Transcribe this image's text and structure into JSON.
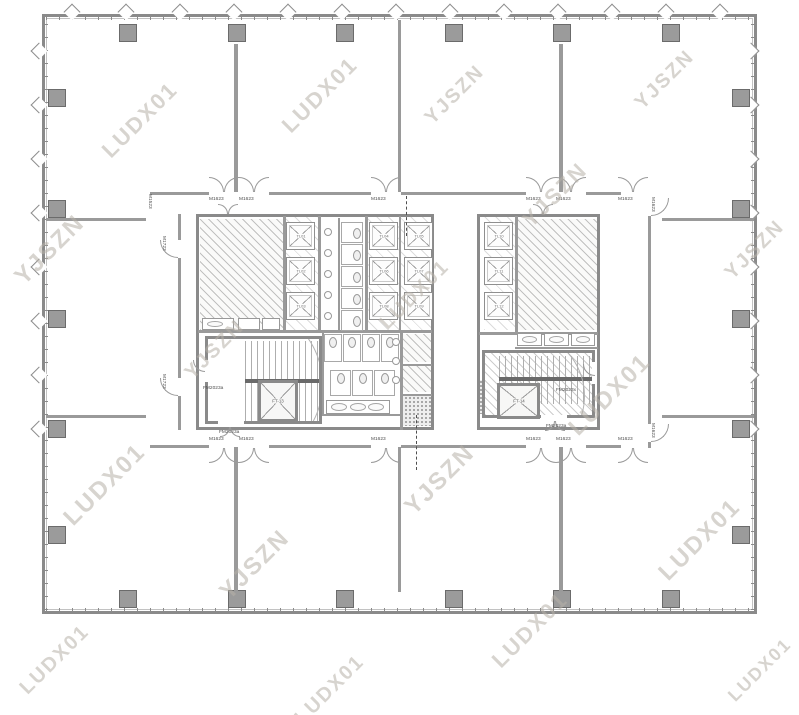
{
  "colors": {
    "wall": "#8a8a8a",
    "line": "#9a9a9a",
    "column": "#9b9b9b",
    "column_border": "#6b6b6b",
    "watermark": "#b7b1a8",
    "dash": "#4f4f4f",
    "label_text": "#4d4d4d"
  },
  "watermark": {
    "texts": [
      "LUDX01",
      "YJSZN"
    ],
    "items": [
      [
        50,
        250,
        "YJSZN",
        24
      ],
      [
        140,
        120,
        "LUDX01",
        22
      ],
      [
        105,
        485,
        "LUDX01",
        24
      ],
      [
        55,
        660,
        "LUDX01",
        20
      ],
      [
        215,
        350,
        "YJSZN",
        20
      ],
      [
        255,
        565,
        "YJSZN",
        24
      ],
      [
        320,
        95,
        "LUDX01",
        22
      ],
      [
        330,
        690,
        "LUDX01",
        20
      ],
      [
        415,
        295,
        "LUDX01",
        20
      ],
      [
        440,
        480,
        "YJSZN",
        24
      ],
      [
        455,
        95,
        "YJSZN",
        20
      ],
      [
        530,
        630,
        "LUDX01",
        22
      ],
      [
        555,
        195,
        "YJSZN",
        22
      ],
      [
        610,
        395,
        "LUDX01",
        24
      ],
      [
        665,
        80,
        "YJSZN",
        20
      ],
      [
        700,
        540,
        "LUDX01",
        24
      ],
      [
        755,
        250,
        "YJSZN",
        20
      ],
      [
        760,
        670,
        "LUDX01",
        18
      ]
    ]
  },
  "shell": {
    "x": 42,
    "y": 14,
    "w": 715,
    "h": 600
  },
  "columns": [
    [
      119,
      24
    ],
    [
      228,
      24
    ],
    [
      336,
      24
    ],
    [
      445,
      24
    ],
    [
      553,
      24
    ],
    [
      662,
      24
    ],
    [
      119,
      590
    ],
    [
      228,
      590
    ],
    [
      336,
      590
    ],
    [
      445,
      590
    ],
    [
      553,
      590
    ],
    [
      662,
      590
    ],
    [
      48,
      89
    ],
    [
      48,
      200
    ],
    [
      48,
      310
    ],
    [
      48,
      420
    ],
    [
      48,
      526
    ],
    [
      732,
      89
    ],
    [
      732,
      200
    ],
    [
      732,
      310
    ],
    [
      732,
      420
    ],
    [
      732,
      526
    ]
  ],
  "windows": {
    "top": [
      72,
      126,
      180,
      234,
      288,
      342,
      396,
      450,
      504,
      558,
      612,
      666,
      720
    ],
    "left": [
      51,
      105,
      159,
      213,
      267,
      321,
      375,
      429
    ],
    "right": [
      51,
      105,
      159,
      213,
      267,
      321,
      375,
      429
    ]
  },
  "walls": [
    [
      234,
      44,
      4,
      148
    ],
    [
      398,
      20,
      3,
      172
    ],
    [
      559,
      44,
      4,
      148
    ],
    [
      234,
      447,
      4,
      145
    ],
    [
      398,
      447,
      3,
      145
    ],
    [
      559,
      447,
      4,
      145
    ],
    [
      46,
      218,
      100,
      3
    ],
    [
      46,
      415,
      100,
      3
    ],
    [
      662,
      218,
      92,
      3
    ],
    [
      662,
      415,
      92,
      3
    ],
    [
      150,
      192,
      59,
      3
    ],
    [
      269,
      192,
      102,
      3
    ],
    [
      401,
      192,
      125,
      3
    ],
    [
      586,
      192,
      35,
      3
    ],
    [
      150,
      445,
      59,
      3
    ],
    [
      269,
      445,
      102,
      3
    ],
    [
      401,
      445,
      125,
      3
    ],
    [
      586,
      445,
      35,
      3
    ],
    [
      178,
      214,
      3,
      26
    ],
    [
      178,
      258,
      3,
      120
    ],
    [
      178,
      396,
      3,
      34
    ],
    [
      648,
      216,
      3,
      208
    ],
    [
      648,
      442,
      3,
      6
    ],
    [
      283,
      216,
      3,
      116
    ],
    [
      318,
      216,
      3,
      116
    ],
    [
      365,
      216,
      3,
      116
    ],
    [
      399,
      216,
      2,
      114
    ],
    [
      198,
      330,
      234,
      3
    ],
    [
      322,
      332,
      2,
      84
    ],
    [
      322,
      414,
      78,
      2
    ],
    [
      400,
      332,
      3,
      98
    ],
    [
      400,
      364,
      32,
      2
    ],
    [
      400,
      394,
      32,
      2
    ],
    [
      338,
      218,
      2,
      112
    ],
    [
      515,
      216,
      3,
      116
    ],
    [
      479,
      332,
      119,
      3
    ],
    [
      515,
      347,
      83,
      2
    ]
  ],
  "cores": [
    [
      196,
      214,
      238,
      216
    ],
    [
      477,
      214,
      123,
      216
    ]
  ],
  "rooms": [
    {
      "x": 200,
      "y": 219,
      "w": 83,
      "h": 111,
      "t": "hatch"
    },
    {
      "x": 283,
      "y": 216,
      "w": 35,
      "h": 114,
      "t": "hlight"
    },
    {
      "x": 365,
      "y": 216,
      "w": 69,
      "h": 114,
      "t": "hlight"
    },
    {
      "x": 484,
      "y": 216,
      "w": 31,
      "h": 114,
      "t": "hlight"
    },
    {
      "x": 517,
      "y": 219,
      "w": 80,
      "h": 111,
      "t": "hatch"
    },
    {
      "x": 400,
      "y": 334,
      "w": 32,
      "h": 28,
      "t": "hatch"
    },
    {
      "x": 400,
      "y": 366,
      "w": 32,
      "h": 26,
      "t": "hatch"
    },
    {
      "x": 400,
      "y": 396,
      "w": 32,
      "h": 30,
      "t": "speckle"
    },
    {
      "x": 479,
      "y": 380,
      "w": 15,
      "h": 34,
      "t": "speckle"
    }
  ],
  "stairs": [
    {
      "x": 205,
      "y": 336,
      "w": 117,
      "h": 88,
      "hatched": false,
      "treads": [
        37,
        2,
        78,
        84
      ],
      "landing": [
        37,
        40,
        78,
        4
      ],
      "arc": [
        -45,
        -35,
        160
      ]
    },
    {
      "x": 482,
      "y": 350,
      "w": 113,
      "h": 68,
      "hatched": true,
      "treads": [
        14,
        3,
        94,
        48
      ],
      "landing": [
        14,
        24,
        94,
        4
      ],
      "arc": [
        -30,
        -22,
        130
      ]
    }
  ],
  "elevators": {
    "car_w": 29,
    "car_h": 28,
    "cars": [
      {
        "x": 286,
        "y": 222,
        "label": "TL01"
      },
      {
        "x": 286,
        "y": 257,
        "label": "TL02"
      },
      {
        "x": 286,
        "y": 292,
        "label": "TL03"
      },
      {
        "x": 369,
        "y": 222,
        "label": "TL04"
      },
      {
        "x": 404,
        "y": 222,
        "label": "TL05"
      },
      {
        "x": 369,
        "y": 257,
        "label": "TL06"
      },
      {
        "x": 404,
        "y": 257,
        "label": "TL07"
      },
      {
        "x": 369,
        "y": 292,
        "label": "TL08"
      },
      {
        "x": 404,
        "y": 292,
        "label": "TL09"
      },
      {
        "x": 484,
        "y": 222,
        "label": "TL10"
      },
      {
        "x": 484,
        "y": 257,
        "label": "TL11"
      },
      {
        "x": 484,
        "y": 292,
        "label": "TL12"
      }
    ],
    "service_lifts": [
      {
        "x": 258,
        "y": 380,
        "w": 40,
        "h": 42,
        "label": "FT-13"
      },
      {
        "x": 497,
        "y": 383,
        "w": 43,
        "h": 36,
        "label": "FT-14"
      }
    ]
  },
  "fixtures": {
    "urinals": [
      [
        324,
        228
      ],
      [
        324,
        249
      ],
      [
        324,
        270
      ],
      [
        324,
        291
      ],
      [
        324,
        312
      ],
      [
        392,
        338
      ],
      [
        392,
        357
      ],
      [
        392,
        376
      ]
    ],
    "stall_groups": [
      {
        "w": 22,
        "h": 21,
        "wc": "r",
        "list": [
          [
            341,
            222
          ],
          [
            341,
            244
          ],
          [
            341,
            266
          ],
          [
            341,
            288
          ],
          [
            341,
            310
          ]
        ]
      },
      {
        "w": 18,
        "h": 28,
        "wc": "t",
        "list": [
          [
            324,
            334
          ],
          [
            343,
            334
          ],
          [
            362,
            334
          ],
          [
            381,
            334
          ]
        ]
      },
      {
        "w": 21,
        "h": 26,
        "wc": "t",
        "list": [
          [
            330,
            370
          ],
          [
            352,
            370
          ],
          [
            374,
            370
          ]
        ]
      }
    ],
    "counters": [
      {
        "x": 326,
        "y": 400,
        "w": 64,
        "h": 14,
        "basins": 3
      },
      {
        "x": 517,
        "y": 333,
        "w": 25,
        "h": 13,
        "basins": 1
      },
      {
        "x": 544,
        "y": 333,
        "w": 25,
        "h": 13,
        "basins": 1
      },
      {
        "x": 571,
        "y": 333,
        "w": 24,
        "h": 13,
        "basins": 1
      },
      {
        "x": 202,
        "y": 318,
        "w": 32,
        "h": 12,
        "basins": 1
      },
      {
        "x": 238,
        "y": 318,
        "w": 22,
        "h": 12,
        "basins": 0
      },
      {
        "x": 262,
        "y": 318,
        "w": 18,
        "h": 12,
        "basins": 0
      }
    ]
  },
  "doors": {
    "double": [
      {
        "x": 209,
        "y": 192,
        "d": "up"
      },
      {
        "x": 239,
        "y": 192,
        "d": "up"
      },
      {
        "x": 371,
        "y": 192,
        "d": "up"
      },
      {
        "x": 526,
        "y": 192,
        "d": "up"
      },
      {
        "x": 556,
        "y": 192,
        "d": "up"
      },
      {
        "x": 618,
        "y": 192,
        "d": "up"
      },
      {
        "x": 209,
        "y": 448,
        "d": "dn"
      },
      {
        "x": 239,
        "y": 448,
        "d": "dn"
      },
      {
        "x": 371,
        "y": 448,
        "d": "dn"
      },
      {
        "x": 526,
        "y": 448,
        "d": "dn"
      },
      {
        "x": 556,
        "y": 448,
        "d": "dn"
      },
      {
        "x": 618,
        "y": 448,
        "d": "dn"
      },
      {
        "x": 218,
        "y": 214,
        "d": "up",
        "s": 10
      },
      {
        "x": 533,
        "y": 214,
        "d": "up",
        "s": 10
      },
      {
        "x": 220,
        "y": 427,
        "d": "dn",
        "s": 10
      },
      {
        "x": 545,
        "y": 421,
        "d": "dn",
        "s": 10
      }
    ],
    "single": [
      {
        "x": 178,
        "y": 240,
        "d": "w"
      },
      {
        "x": 178,
        "y": 378,
        "d": "w"
      },
      {
        "x": 648,
        "y": 198,
        "d": "e"
      },
      {
        "x": 648,
        "y": 424,
        "d": "e"
      },
      {
        "x": 205,
        "y": 360,
        "d": "w",
        "s": 12
      },
      {
        "x": 595,
        "y": 364,
        "d": "w",
        "s": 12
      }
    ],
    "gaps": [
      [
        203,
        360,
        5,
        22
      ],
      [
        218,
        421,
        26,
        5
      ],
      [
        592,
        362,
        5,
        22
      ],
      [
        541,
        415,
        26,
        5
      ]
    ]
  },
  "dashes": [
    [
      406,
      196,
      40
    ],
    [
      416,
      415,
      55
    ]
  ],
  "labels": [
    {
      "x": 209,
      "y": 196,
      "t": "M1623"
    },
    {
      "x": 239,
      "y": 196,
      "t": "M1623"
    },
    {
      "x": 371,
      "y": 196,
      "t": "M1623"
    },
    {
      "x": 526,
      "y": 196,
      "t": "M1623"
    },
    {
      "x": 556,
      "y": 196,
      "t": "M1623"
    },
    {
      "x": 618,
      "y": 196,
      "t": "M1623"
    },
    {
      "x": 209,
      "y": 436,
      "t": "M1623"
    },
    {
      "x": 239,
      "y": 436,
      "t": "M1623"
    },
    {
      "x": 371,
      "y": 436,
      "t": "M1623"
    },
    {
      "x": 526,
      "y": 436,
      "t": "M1623"
    },
    {
      "x": 556,
      "y": 436,
      "t": "M1623"
    },
    {
      "x": 618,
      "y": 436,
      "t": "M1623"
    },
    {
      "x": 167,
      "y": 236,
      "t": "M1723",
      "r": 90
    },
    {
      "x": 167,
      "y": 374,
      "t": "M1723",
      "r": 90
    },
    {
      "x": 656,
      "y": 197,
      "t": "M1623",
      "r": 90
    },
    {
      "x": 656,
      "y": 423,
      "t": "M1623",
      "r": 90
    },
    {
      "x": 153,
      "y": 194,
      "t": "M1523",
      "r": 90
    },
    {
      "x": 203,
      "y": 385,
      "t": "FM2023a"
    },
    {
      "x": 219,
      "y": 429,
      "t": "FM2023a"
    },
    {
      "x": 546,
      "y": 423,
      "t": "FM2023a"
    },
    {
      "x": 556,
      "y": 387,
      "t": "FM2023x"
    }
  ]
}
